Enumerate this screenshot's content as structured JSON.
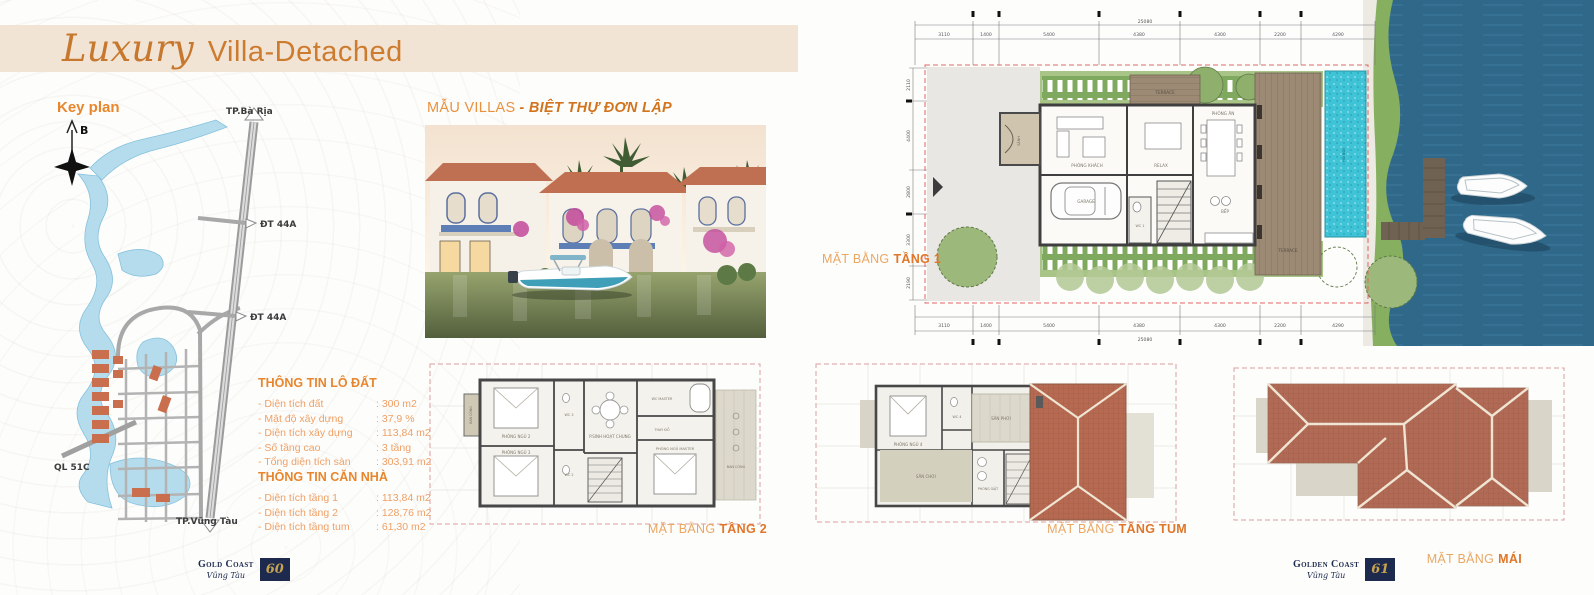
{
  "header": {
    "script": "Luxury",
    "title": "Villa-Detached"
  },
  "key_plan": {
    "title": "Key plan",
    "compass": "B",
    "labels": {
      "city_top": "TP.Bà Rịa",
      "road_1": "ĐT 44A",
      "road_2": "ĐT 44A",
      "road_3": "QL 51C",
      "city_bottom": "TP.Vũng Tàu"
    }
  },
  "villa": {
    "title": "MẪU VILLAS",
    "subtitle": "- BIỆT THỰ ĐƠN LẬP"
  },
  "land_info": {
    "title": "THÔNG TIN LÔ ĐẤT",
    "rows": [
      {
        "label": "- Diện tích đất",
        "value": ": 300 m2"
      },
      {
        "label": "- Mật độ xây dựng",
        "value": ": 37,9 %"
      },
      {
        "label": "- Diện tích xây dựng",
        "value": ": 113,84 m2"
      },
      {
        "label": "- Số tầng cao",
        "value": ": 3 tầng"
      },
      {
        "label": "- Tổng diện tích sàn",
        "value": ": 303,91 m2"
      }
    ]
  },
  "house_info": {
    "title": "THÔNG TIN CĂN NHÀ",
    "rows": [
      {
        "label": "- Diện tích tầng 1",
        "value": ": 113,84 m2"
      },
      {
        "label": "- Diện tích tầng 2",
        "value": ": 128,76 m2"
      },
      {
        "label": "- Diện tích tầng tum",
        "value": ": 61,30 m2"
      }
    ]
  },
  "plans": {
    "floor1": {
      "caption": "MẶT BẰNG",
      "caption_bold": "TẦNG 1",
      "total_dim": "25080",
      "dims": [
        "3110",
        "1400",
        "5400",
        "4380",
        "4300",
        "2200",
        "4290"
      ],
      "side_dims": [
        "2110",
        "4400",
        "2800",
        "3300",
        "2190"
      ],
      "rooms": {
        "terrace_top": "TERRACE",
        "living": "PHÒNG KHÁCH",
        "relax": "RELAX",
        "dining": "PHÒNG ĂN",
        "garage": "GARAGE",
        "wc": "WC 1",
        "kitchen": "BẾP",
        "terrace_right": "TERRACE",
        "pool": "HỒ BƠI",
        "hall": "SẢNH"
      }
    },
    "floor2": {
      "caption": "MẶT BẰNG",
      "caption_bold": "TẦNG 2",
      "rooms": {
        "bed2": "PHÒNG NGỦ 2",
        "bed3": "PHÒNG NGỦ 3",
        "wc2": "WC 2",
        "wc3": "WC 3",
        "common": "P.SINH HOẠT CHUNG",
        "wc_master": "WC MASTER",
        "dressing": "THAY ĐỒ",
        "master": "PHÒNG NGỦ MASTER",
        "balcony_left": "BAN CÔNG",
        "balcony_right": "BAN CÔNG"
      }
    },
    "tum": {
      "caption": "MẶT BẰNG",
      "caption_bold": "TẦNG TUM",
      "rooms": {
        "bed4": "PHÒNG NGỦ 4",
        "wc4": "WC 4",
        "drying": "SÂN PHƠI",
        "play": "SÂN CHƠI",
        "laundry": "PHÒNG GIẶT"
      }
    },
    "roof": {
      "caption": "MẶT BẰNG",
      "caption_bold": "MÁI"
    }
  },
  "footer_left": {
    "brand": "Gold Coast",
    "place": "Vũng Tàu",
    "page": "60"
  },
  "footer_right": {
    "brand": "Golden Coast",
    "place": "Vũng Tàu",
    "page": "61"
  },
  "colors": {
    "accent": "#e0812f",
    "band": "#f2e4d4",
    "navy": "#1d2a4e",
    "water": "#2f6c8c",
    "pool": "#3fc3d6",
    "roof": "#b66a52",
    "map_water": "#b5dcec",
    "lot": "#c96f4d"
  }
}
